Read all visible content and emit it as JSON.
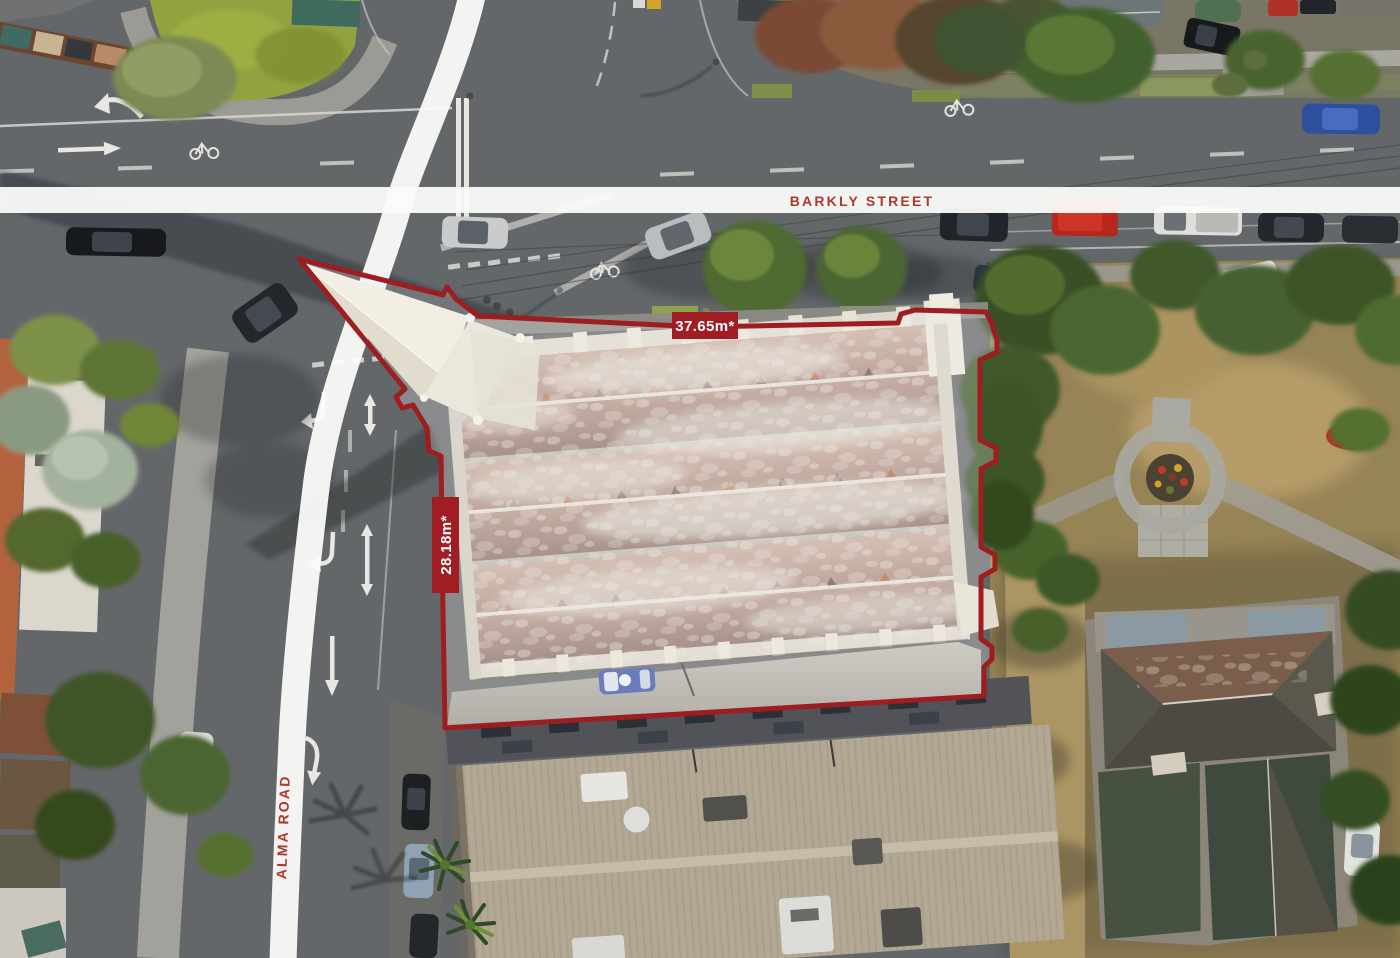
{
  "annotations": {
    "street_top": {
      "label": "BARKLY STREET"
    },
    "street_left": {
      "label": "ALMA ROAD"
    },
    "frontage": {
      "label": "37.65m*"
    },
    "depth": {
      "label": "28.18m*"
    }
  },
  "colors": {
    "boundary": "#9d1d20",
    "measure_bg": "#a01e23",
    "measure_text": "#ffffff",
    "street_text": "#ad392c",
    "band": "#fbfbf9",
    "property_highlight": "rgba(255,255,255,0.24)"
  }
}
